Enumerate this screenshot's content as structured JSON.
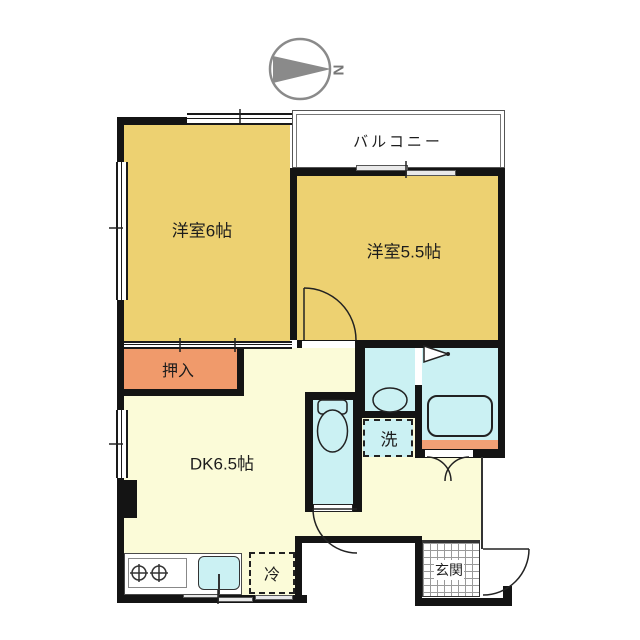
{
  "plan": {
    "compass_letter": "N",
    "rooms": {
      "balcony": {
        "label": "バルコニー"
      },
      "western_room_6": {
        "label": "洋室6帖"
      },
      "western_room_5_5": {
        "label": "洋室5.5帖"
      },
      "closet": {
        "label": "押入"
      },
      "dining_kitchen": {
        "label": "DK6.5帖"
      },
      "washer_space": {
        "label": "洗"
      },
      "refrigerator_space": {
        "label": "冷"
      },
      "entrance": {
        "label": "玄関"
      }
    },
    "colors": {
      "room_fill": "#EDD171",
      "dk_fill": "#FBFBD8",
      "wet_area_fill": "#CBF1F3",
      "closet_fill": "#F09A6B",
      "step_fill": "#F0A075",
      "wall": "#141414",
      "compass": "#8A8A8A"
    }
  }
}
